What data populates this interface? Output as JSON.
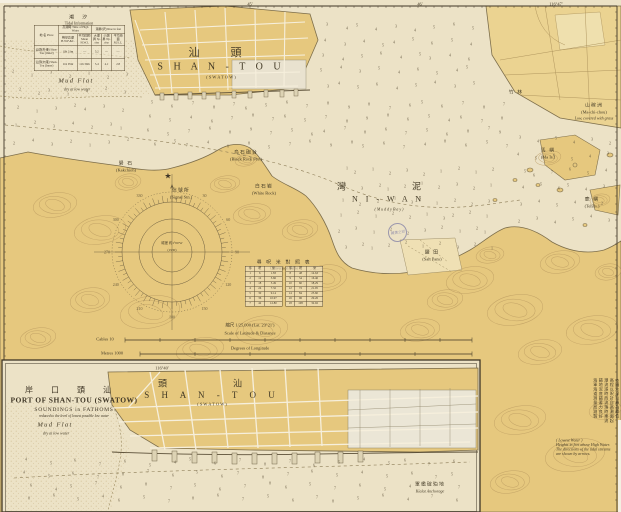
{
  "map": {
    "corner_coord": "116°47′",
    "grat_tick_1": "45′",
    "grat_tick_2": "46′"
  },
  "tidal_table": {
    "title_zh": "潮　汐",
    "title_en": "Tidal Information",
    "group1": "高潮時 Time of High Water",
    "group2": "潮昇(呎) Rise in feet",
    "col_headers": [
      "地 名 Place",
      "朔望高潮 H.W.F.&C.",
      "平均間隙 Mean H.W.I.",
      "大潮昇 Sp. rise",
      "小潮昇 Np. rise",
      "平均海面 M.S.L."
    ],
    "rows": [
      [
        "汕頭(外港) Shan-Tou (Outer)",
        "10h 31m",
        "—",
        "5.2",
        "—",
        "—"
      ],
      [
        "汕頭(內港) Shan-Tou (Inner)",
        "11h 05m",
        "11h 30m",
        "5.4",
        "4.1",
        "2.8"
      ]
    ]
  },
  "conversion_table": {
    "title_zh": "尋 呎 米 對 照 表",
    "subtitle": "Conversion Table",
    "left": {
      "headers": [
        "尋",
        "呎",
        "米"
      ],
      "rows": [
        [
          "1",
          "6",
          "1.83"
        ],
        [
          "2",
          "12",
          "3.66"
        ],
        [
          "3",
          "18",
          "5.49"
        ],
        [
          "4",
          "24",
          "7.32"
        ],
        [
          "5",
          "30",
          "9.14"
        ],
        [
          "6",
          "36",
          "10.97"
        ],
        [
          "7",
          "42",
          "12.80"
        ]
      ]
    },
    "right": {
      "headers": [
        "尋",
        "呎",
        "米"
      ],
      "rows": [
        [
          "8",
          "48",
          "14.63"
        ],
        [
          "9",
          "54",
          "16.46"
        ],
        [
          "10",
          "60",
          "18.29"
        ],
        [
          "12",
          "72",
          "21.95"
        ],
        [
          "14",
          "84",
          "25.60"
        ],
        [
          "16",
          "96",
          "29.26"
        ],
        [
          "18",
          "108",
          "32.92"
        ]
      ]
    }
  },
  "scale": {
    "ratio": "縮尺 1/25,000 (Lat. 23°21′)",
    "lat_label": "Scale of Latitude & Distance",
    "lon_label": "Degrees of Longitude",
    "cables_label": "Cables 10",
    "metres_label": "Metres 1000"
  },
  "inset": {
    "title_zh": "岸 口 頭 汕",
    "title_en": "PORT OF SHAN-TOU (SWATOW)",
    "sub1": "SOUNDINGS in FATHOMS",
    "sub2": "reduced to the level of lowest possible low water",
    "meridian": "116°40′"
  },
  "notes": {
    "columns": [
      "本圖水深以尋為單位",
      "高程以呎計自高潮面起",
      "潮流漲時西流落時東流",
      "錨地泥底錨著力良好",
      "海軍海道測量局測製"
    ],
    "en_lines": [
      "( Lowest Water )",
      "Heights in feet above High Water.",
      "The directions of the tidal streams",
      "are shown by arrows."
    ]
  },
  "stamp": {
    "text": "藏書之印"
  },
  "symbols": {
    "lighthouse_star": "★"
  },
  "labels": [
    {
      "id": "city-zh",
      "text": "汕　頭",
      "x": 220,
      "y": 52,
      "cls": "zh-lg"
    },
    {
      "id": "city-en",
      "text": "S H A N - T O U",
      "x": 221,
      "y": 67,
      "cls": "en-lg"
    },
    {
      "id": "city-sub",
      "text": "( S W A T O W )",
      "x": 221,
      "y": 77,
      "cls": "en-xs"
    },
    {
      "id": "mudflat-en",
      "text": "Mud  Flat",
      "x": 76,
      "y": 81,
      "cls": "en-it"
    },
    {
      "id": "mudflat-sub",
      "text": "dry at low water",
      "x": 77,
      "y": 89,
      "cls": "en-xs-it"
    },
    {
      "id": "niwan-zh",
      "text": "灣　　泥",
      "x": 387,
      "y": 186,
      "cls": "zh-md"
    },
    {
      "id": "niwan-en",
      "text": "N I  -  W A N",
      "x": 388,
      "y": 199,
      "cls": "en-md"
    },
    {
      "id": "niwan-sub",
      "text": "( M u d d y   B a y )",
      "x": 389,
      "y": 209,
      "cls": "en-xs-it"
    },
    {
      "id": "kakchioh-zh",
      "text": "礐 石",
      "x": 126,
      "y": 163,
      "cls": "zh-sm"
    },
    {
      "id": "kakchioh-en",
      "text": "(Kakchioh)",
      "x": 126,
      "y": 170,
      "cls": "en-xs"
    },
    {
      "id": "fort-zh",
      "text": "烏石砲台",
      "x": 246,
      "y": 152,
      "cls": "zh-sm"
    },
    {
      "id": "fort-en",
      "text": "(Black Rock Fort)",
      "x": 246,
      "y": 159,
      "cls": "en-xs"
    },
    {
      "id": "whiterock-zh",
      "text": "白石岩",
      "x": 264,
      "y": 186,
      "cls": "zh-sm"
    },
    {
      "id": "whiterock-en",
      "text": "(White Rock)",
      "x": 264,
      "y": 193,
      "cls": "en-xs"
    },
    {
      "id": "signal-zh",
      "text": "信號所",
      "x": 181,
      "y": 190,
      "cls": "zh-sm"
    },
    {
      "id": "signal-en",
      "text": "(Signal Stn.)",
      "x": 181,
      "y": 197,
      "cls": "en-xs"
    },
    {
      "id": "saltpans-zh",
      "text": "鹽 田",
      "x": 432,
      "y": 252,
      "cls": "zh-sm"
    },
    {
      "id": "saltpans-en",
      "text": "(Salt Pans)",
      "x": 432,
      "y": 259,
      "cls": "en-xs"
    },
    {
      "id": "ma-isl-zh",
      "text": "馬 嶼",
      "x": 548,
      "y": 150,
      "cls": "zh-sm"
    },
    {
      "id": "ma-isl-en",
      "text": "(Ma Is.)",
      "x": 548,
      "y": 157,
      "cls": "en-xs"
    },
    {
      "id": "teh-isl-zh",
      "text": "鹿 嶼",
      "x": 592,
      "y": 199,
      "cls": "zh-sm"
    },
    {
      "id": "teh-isl-en",
      "text": "(Teh Is.)",
      "x": 592,
      "y": 206,
      "cls": "en-xs"
    },
    {
      "id": "low-isl-zh",
      "text": "山稼洲",
      "x": 594,
      "y": 105,
      "cls": "zh-sm"
    },
    {
      "id": "low-isl-en",
      "text": "(Ma-chi-chou)",
      "x": 594,
      "y": 112,
      "cls": "en-xs"
    },
    {
      "id": "low-isl-sub",
      "text": "Low, covered with grass",
      "x": 594,
      "y": 118,
      "cls": "en-xs-it"
    },
    {
      "id": "bamboo-zh",
      "text": "竹 林",
      "x": 516,
      "y": 92,
      "cls": "zh-sm"
    },
    {
      "id": "anchorage-zh",
      "text": "軍艦碇泊地",
      "x": 430,
      "y": 484,
      "cls": "zh-sm"
    },
    {
      "id": "anchorage-en",
      "text": "Kialat  Anchorage",
      "x": 430,
      "y": 491,
      "cls": "en-xs-it"
    },
    {
      "id": "inset-meridian",
      "text": "116°40′",
      "x": 162,
      "y": 368,
      "cls": "en-xs"
    },
    {
      "id": "corner-coord",
      "text": "116°47′",
      "x": 556,
      "y": 4,
      "cls": "en-xs"
    },
    {
      "id": "grat-45",
      "text": "45′",
      "x": 250,
      "y": 4,
      "cls": "en-xs"
    },
    {
      "id": "grat-46",
      "text": "46′",
      "x": 420,
      "y": 4,
      "cls": "en-xs"
    },
    {
      "id": "inset-city-zh",
      "text": "頭　　汕",
      "x": 208,
      "y": 383,
      "cls": "zh-md"
    },
    {
      "id": "inset-city-en",
      "text": "S H A N  -  T O U",
      "x": 212,
      "y": 395,
      "cls": "en-md-sp"
    },
    {
      "id": "inset-city-sub",
      "text": "( S W A T O W )",
      "x": 212,
      "y": 404,
      "cls": "en-xs"
    },
    {
      "id": "inset-mudflat",
      "text": "Mud  Flat",
      "x": 55,
      "y": 425,
      "cls": "en-it"
    },
    {
      "id": "inset-mudflat-sub",
      "text": "dry at low water",
      "x": 56,
      "y": 433,
      "cls": "en-xs-it"
    },
    {
      "id": "compass-note1",
      "text": "磁差 約1°00′W",
      "x": 172,
      "y": 243,
      "cls": "en-xxs"
    },
    {
      "id": "compass-note2",
      "text": "(1930)",
      "x": 172,
      "y": 250,
      "cls": "en-xxs"
    },
    {
      "id": "scale-ratio",
      "text": "縮尺 1/25,000 (Lat. 23°21′)",
      "x": 250,
      "y": 325,
      "cls": "en-xs"
    },
    {
      "id": "scale-lat-label",
      "text": "Scale of Latitude & Distance",
      "x": 250,
      "y": 333,
      "cls": "en-xs"
    },
    {
      "id": "scale-cables",
      "text": "Cables 10",
      "x": 105,
      "y": 339,
      "cls": "en-xs"
    },
    {
      "id": "scale-lon-label",
      "text": "Degrees of Longitude",
      "x": 250,
      "y": 348,
      "cls": "en-xs"
    },
    {
      "id": "scale-metres",
      "text": "Metres 1000",
      "x": 112,
      "y": 353,
      "cls": "en-xs"
    }
  ],
  "soundings": {
    "regions": [
      {
        "x": 8,
        "y": 66,
        "w": 126,
        "h": 84,
        "cols": 7,
        "rows": 5,
        "values": "2 1 3 2 1 2 3 2 2 3 1 4 2 3 2 1 3 2 4 3 2 1 2 3 4 2 3 1 2 4 3 2 1 3 2"
      },
      {
        "x": 142,
        "y": 98,
        "w": 372,
        "h": 52,
        "cols": 19,
        "rows": 4,
        "values": "5 6 7 8 7 6 5 6 7 8 9 8 7 6 5 6 7 8 7 6 5 4 6 7 8 7 6 5 7 8 9 8 6 5 4 6 7 8 6 5 7 6 8 9 7 5 6 4 7 8 6 7 5 6 8 7 9 6 5 7 4 6 8 5 7 6 9 8 5 6 7 4 8 6 5 7"
      },
      {
        "x": 335,
        "y": 164,
        "w": 162,
        "h": 88,
        "cols": 10,
        "rows": 6,
        "values": "1 2 1 2 3 2 1 2 1 2 2 3 2 1 2 1 2 3 2 1 1 2 2 1 3 2 1 2 2 3 1 2 1 2 2 1 3 2 2 1 2 3 1 2 2 3 2 1 2 1 3 2 1 2 2 1 2 3 2 1"
      },
      {
        "x": 512,
        "y": 132,
        "w": 102,
        "h": 95,
        "cols": 6,
        "rows": 6,
        "values": "3 4 5 4 3 2 4 5 6 5 4 3 5 6 7 6 5 4 4 5 6 5 4 3 3 4 5 4 3 2 2 3 4 5 4 3"
      },
      {
        "x": 315,
        "y": 20,
        "w": 165,
        "h": 72,
        "cols": 9,
        "rows": 5,
        "values": "3 4 5 4 3 4 5 6 5 4 3 4 5 4 5 6 5 4 3 4 5 6 4 5 3 4 6 5 4 3 5 4 6 5 4 5 3 4 5 6 4 5 4 3 5"
      },
      {
        "x": 16,
        "y": 456,
        "w": 452,
        "h": 48,
        "cols": 19,
        "rows": 4,
        "values": "4 5 6 7 6 5 4 5 6 7 8 7 6 5 4 5 6 7 6 4 5 6 7 8 7 6 5 6 7 8 7 6 5 4 5 6 7 5 6 4 5 7 6 8 7 5 6 7 8 6 5 7 6 5 4 6 7 8 6 5 4 6 5 7 8 6 7 5 6 7 8 5 6 4 7 6"
      }
    ]
  }
}
